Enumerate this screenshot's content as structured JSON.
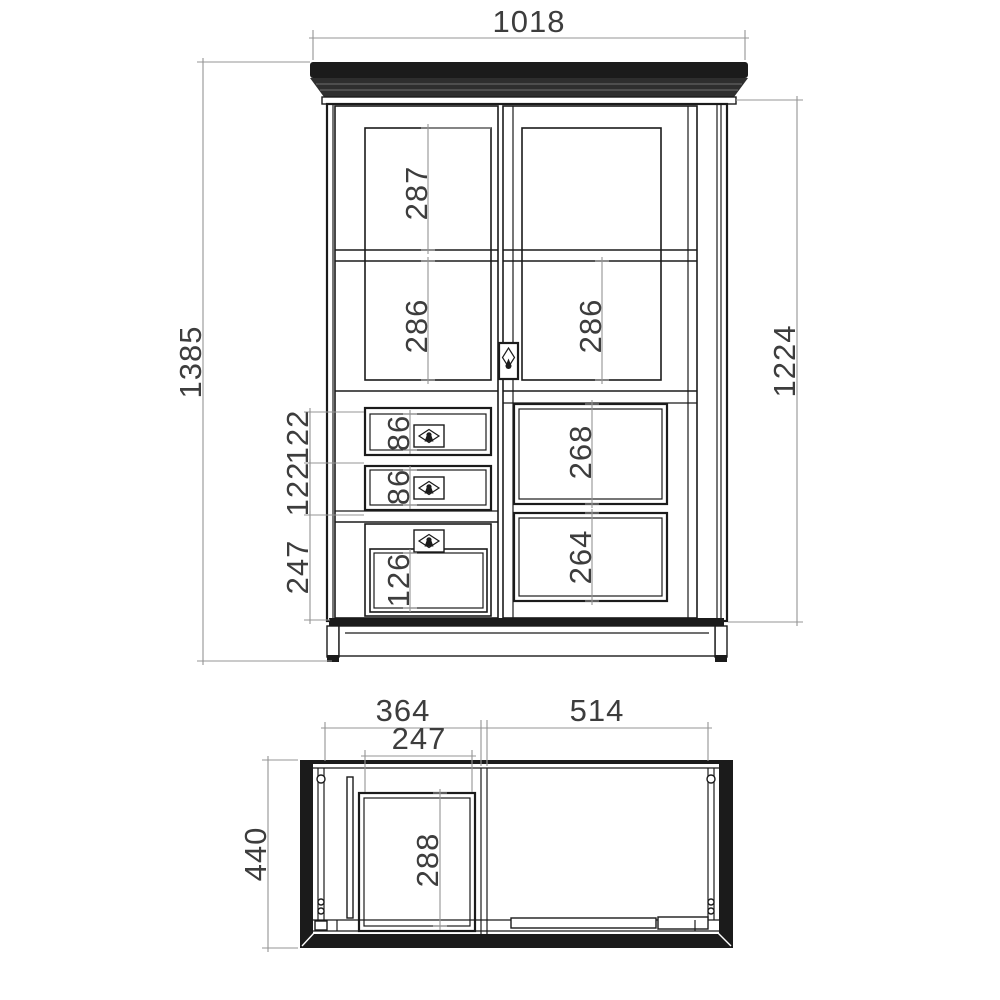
{
  "front": {
    "overall_width": "1018",
    "overall_height": "1385",
    "carcass_height": "1224",
    "left_glass_upper": "287",
    "left_glass_lower": "286",
    "right_glass": "286",
    "right_panel_upper": "268",
    "right_panel_lower": "264",
    "drawer_front_1": "122",
    "drawer_front_2": "122",
    "lower_door_front": "247",
    "drawer_opening_1": "86",
    "drawer_opening_2": "86",
    "lower_door_panel": "126"
  },
  "top": {
    "left_section_width": "364",
    "right_section_width": "514",
    "drawer_width": "247",
    "drawer_depth": "288",
    "overall_depth": "440"
  },
  "colors": {
    "line": "#1b1b1b",
    "dim": "#949494",
    "text": "#3d3d3d",
    "bg": "#ffffff"
  }
}
